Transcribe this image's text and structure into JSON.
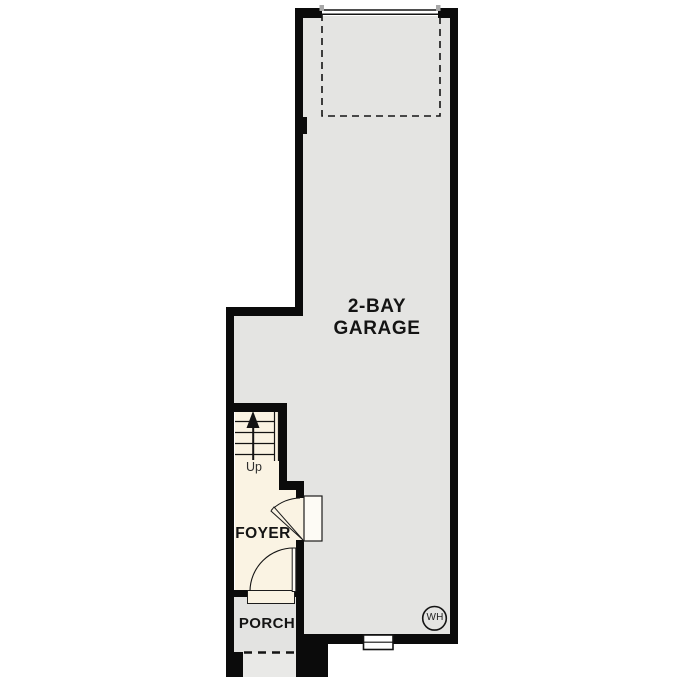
{
  "floor_plan": {
    "rooms": [
      {
        "name": "garage",
        "label_line1": "2-BAY",
        "label_line2": "GARAGE"
      },
      {
        "name": "foyer",
        "label": "FOYER"
      },
      {
        "name": "porch",
        "label": "PORCH"
      }
    ],
    "annotations": {
      "stairs_direction": "Up",
      "water_heater": "WH"
    },
    "colors": {
      "wall": "#0b0b0b",
      "garage_floor": "#e4e4e2",
      "foyer_floor": "#faf3e3",
      "porch_floor": "#e3e3e1",
      "step": "#e9e9e7",
      "door_panel": "#fdfbf5",
      "line": "#141414",
      "jamb_tick": "#a8a8a8",
      "background": "#ffffff"
    }
  }
}
